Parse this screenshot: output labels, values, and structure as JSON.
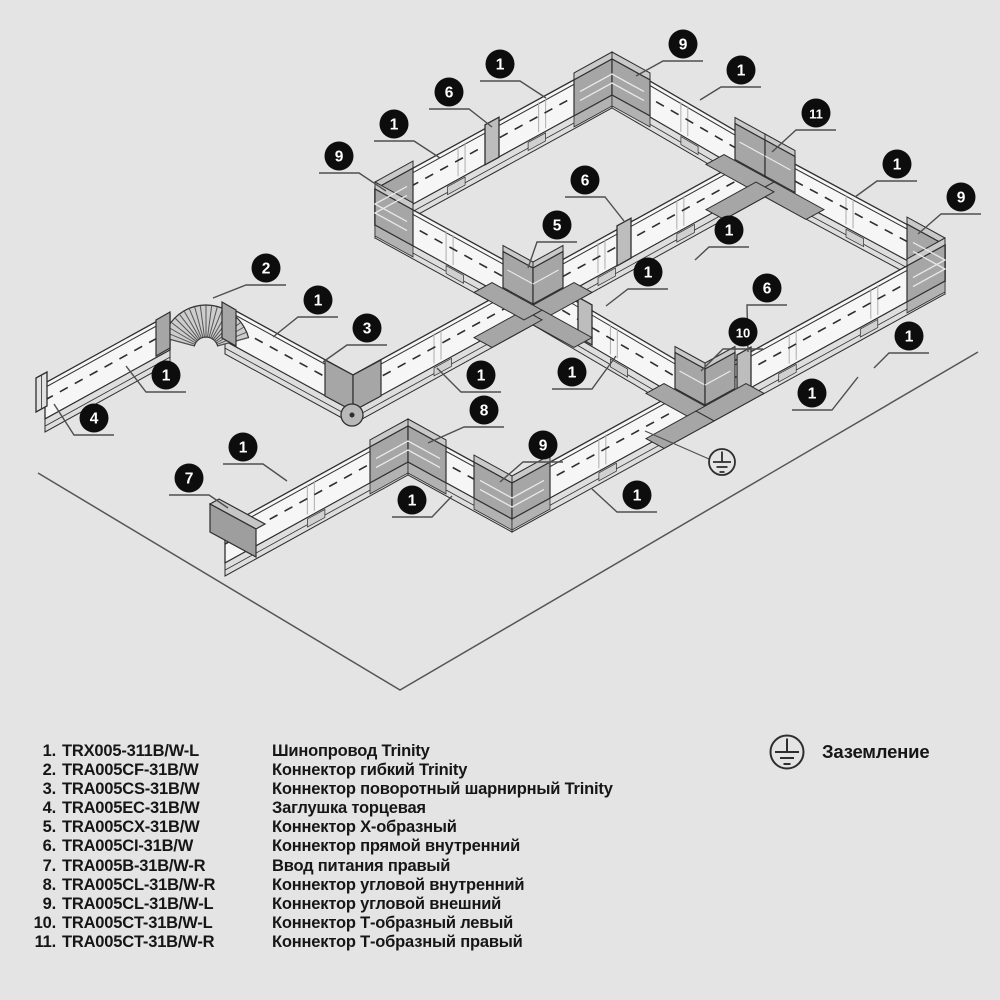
{
  "diagram": {
    "colors": {
      "background": "#e4e4e4",
      "line": "#2e2e2e",
      "leader": "#4f4f4f",
      "floor": "#555555",
      "track_face": "#f6f6f6",
      "track_base": "#dedede",
      "connector_dark": "#a6a6a6",
      "connector_top": "#c9c9c9",
      "connector_mid": "#bdbdbd",
      "callout_fill": "#0d0d0d",
      "callout_text": "#ffffff"
    },
    "callouts": [
      {
        "n": "9",
        "x": 683,
        "y": 44,
        "tx": 636,
        "ty": 76
      },
      {
        "n": "1",
        "x": 500,
        "y": 64,
        "tx": 546,
        "ty": 98
      },
      {
        "n": "1",
        "x": 741,
        "y": 70,
        "tx": 700,
        "ty": 100
      },
      {
        "n": "6",
        "x": 449,
        "y": 92,
        "tx": 492,
        "ty": 127
      },
      {
        "n": "11",
        "x": 816,
        "y": 113,
        "tx": 772,
        "ty": 152
      },
      {
        "n": "1",
        "x": 394,
        "y": 124,
        "tx": 440,
        "ty": 158
      },
      {
        "n": "9",
        "x": 339,
        "y": 156,
        "tx": 386,
        "ty": 191
      },
      {
        "n": "1",
        "x": 897,
        "y": 164,
        "tx": 855,
        "ty": 197
      },
      {
        "n": "9",
        "x": 961,
        "y": 197,
        "tx": 918,
        "ty": 234
      },
      {
        "n": "6",
        "x": 585,
        "y": 180,
        "tx": 624,
        "ty": 221
      },
      {
        "n": "5",
        "x": 557,
        "y": 225,
        "tx": 528,
        "ty": 268
      },
      {
        "n": "1",
        "x": 729,
        "y": 230,
        "tx": 695,
        "ty": 260
      },
      {
        "n": "2",
        "x": 266,
        "y": 268,
        "tx": 213,
        "ty": 298
      },
      {
        "n": "1",
        "x": 648,
        "y": 272,
        "tx": 606,
        "ty": 306
      },
      {
        "n": "1",
        "x": 318,
        "y": 300,
        "tx": 273,
        "ty": 337
      },
      {
        "n": "6",
        "x": 767,
        "y": 288,
        "tx": 748,
        "ty": 352
      },
      {
        "n": "3",
        "x": 367,
        "y": 328,
        "tx": 323,
        "ty": 362
      },
      {
        "n": "10",
        "x": 743,
        "y": 332,
        "tx": 701,
        "ty": 371
      },
      {
        "n": "1",
        "x": 909,
        "y": 336,
        "tx": 874,
        "ty": 368
      },
      {
        "n": "1",
        "x": 166,
        "y": 375,
        "tx": 126,
        "ty": 366
      },
      {
        "n": "1",
        "x": 481,
        "y": 375,
        "tx": 437,
        "ty": 368
      },
      {
        "n": "1",
        "x": 572,
        "y": 372,
        "tx": 616,
        "ty": 356
      },
      {
        "n": "1",
        "x": 812,
        "y": 393,
        "tx": 858,
        "ty": 377
      },
      {
        "n": "8",
        "x": 484,
        "y": 410,
        "tx": 428,
        "ty": 443
      },
      {
        "n": "4",
        "x": 94,
        "y": 418,
        "tx": 54,
        "ty": 404
      },
      {
        "n": "1",
        "x": 243,
        "y": 447,
        "tx": 287,
        "ty": 481
      },
      {
        "n": "9",
        "x": 543,
        "y": 445,
        "tx": 500,
        "ty": 482
      },
      {
        "n": "7",
        "x": 189,
        "y": 478,
        "tx": 228,
        "ty": 508
      },
      {
        "n": "1",
        "x": 412,
        "y": 500,
        "tx": 452,
        "ty": 496
      },
      {
        "n": "1",
        "x": 637,
        "y": 495,
        "tx": 592,
        "ty": 489
      }
    ],
    "ground_symbol": {
      "x": 722,
      "y": 462,
      "leader": [
        709,
        459,
        645,
        431
      ]
    }
  },
  "legend": {
    "items": [
      {
        "num": "1.",
        "code": "TRX005-311B/W-L",
        "desc": "Шинопровод Trinity"
      },
      {
        "num": "2.",
        "code": "TRA005CF-31B/W",
        "desc": "Коннектор гибкий Trinity"
      },
      {
        "num": "3.",
        "code": "TRA005CS-31B/W",
        "desc": "Коннектор поворотный шарнирный Trinity"
      },
      {
        "num": "4.",
        "code": "TRA005EC-31B/W",
        "desc": "Заглушка торцевая"
      },
      {
        "num": "5.",
        "code": "TRA005CX-31B/W",
        "desc": "Коннектор X-образный"
      },
      {
        "num": "6.",
        "code": "TRA005CI-31B/W",
        "desc": "Коннектор прямой внутренний"
      },
      {
        "num": "7.",
        "code": "TRA005B-31B/W-R",
        "desc": "Ввод питания правый"
      },
      {
        "num": "8.",
        "code": "TRA005CL-31B/W-R",
        "desc": "Коннектор угловой внутренний"
      },
      {
        "num": "9.",
        "code": "TRA005CL-31B/W-L",
        "desc": "Коннектор угловой внешний"
      },
      {
        "num": "10.",
        "code": "TRA005CT-31B/W-L",
        "desc": "Коннектор Т-образный левый"
      },
      {
        "num": "11.",
        "code": "TRA005CT-31B/W-R",
        "desc": "Коннектор Т-образный правый"
      }
    ],
    "ground_label": "Заземление"
  }
}
